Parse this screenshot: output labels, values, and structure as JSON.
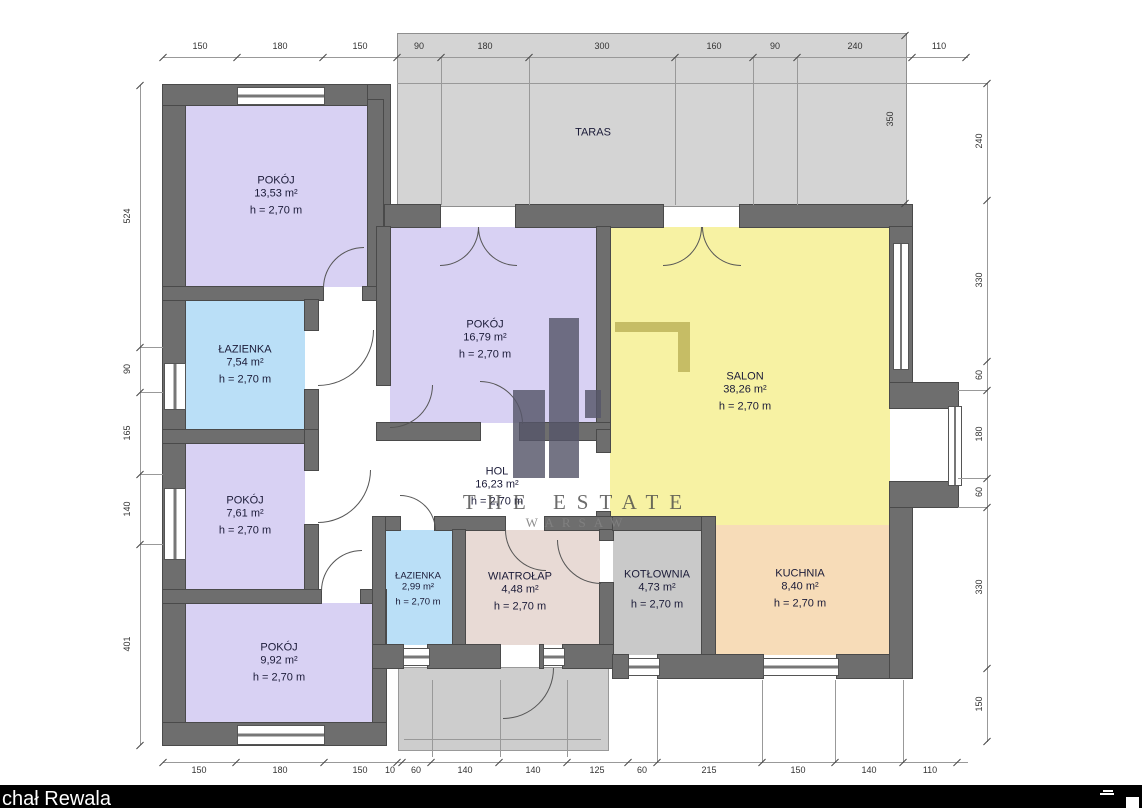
{
  "footer": {
    "author": "chał Rewala"
  },
  "watermark": {
    "line1": "THE ESTATE",
    "line2": "WARSAW"
  },
  "terrace": {
    "label": "TARAS"
  },
  "rooms": [
    {
      "name": "POKÓJ",
      "area": "13,53 m²",
      "height": "h = 2,70 m",
      "color": "#d8d1f3"
    },
    {
      "name": "ŁAZIENKA",
      "area": "7,54 m²",
      "height": "h = 2,70 m",
      "color": "#badff7"
    },
    {
      "name": "POKÓJ",
      "area": "7,61 m²",
      "height": "h = 2,70 m",
      "color": "#d8d1f3"
    },
    {
      "name": "POKÓJ",
      "area": "9,92 m²",
      "height": "h = 2,70 m",
      "color": "#d8d1f3"
    },
    {
      "name": "POKÓJ",
      "area": "16,79 m²",
      "height": "h = 2,70 m",
      "color": "#d8d1f3"
    },
    {
      "name": "HOL",
      "area": "16,23 m²",
      "height": "h = 2,70 m",
      "color": "#ffffff"
    },
    {
      "name": "SALON",
      "area": "38,26 m²",
      "height": "h = 2,70 m",
      "color": "#f7f2a3"
    },
    {
      "name": "ŁAZIENKA",
      "area": "2,99 m²",
      "height": "h = 2,70 m",
      "color": "#badff7"
    },
    {
      "name": "WIATROŁAP",
      "area": "4,48 m²",
      "height": "h = 2,70 m",
      "color": "#e8dad5"
    },
    {
      "name": "KOTŁOWNIA",
      "area": "4,73 m²",
      "height": "h = 2,70 m",
      "color": "#c9c9c9"
    },
    {
      "name": "KUCHNIA",
      "area": "8,40 m²",
      "height": "h = 2,70 m",
      "color": "#f7dcb8"
    }
  ],
  "dimensions": {
    "top": [
      "150",
      "180",
      "150",
      "90",
      "180",
      "300",
      "160",
      "90",
      "240",
      "110"
    ],
    "bottom": [
      "150",
      "180",
      "150",
      "10",
      "60",
      "140",
      "140",
      "125",
      "60",
      "215",
      "150",
      "140",
      "110"
    ],
    "left": [
      "524",
      "90",
      "165",
      "140",
      "401"
    ],
    "right": [
      "240",
      "330",
      "60",
      "180",
      "60",
      "330",
      "150"
    ],
    "terrace_depth": "350"
  },
  "palette": {
    "wall": "#6e6e6e",
    "terrace": "#d4d4d4",
    "stoop": "#cdcdcd",
    "dimension_text": "#333333"
  }
}
